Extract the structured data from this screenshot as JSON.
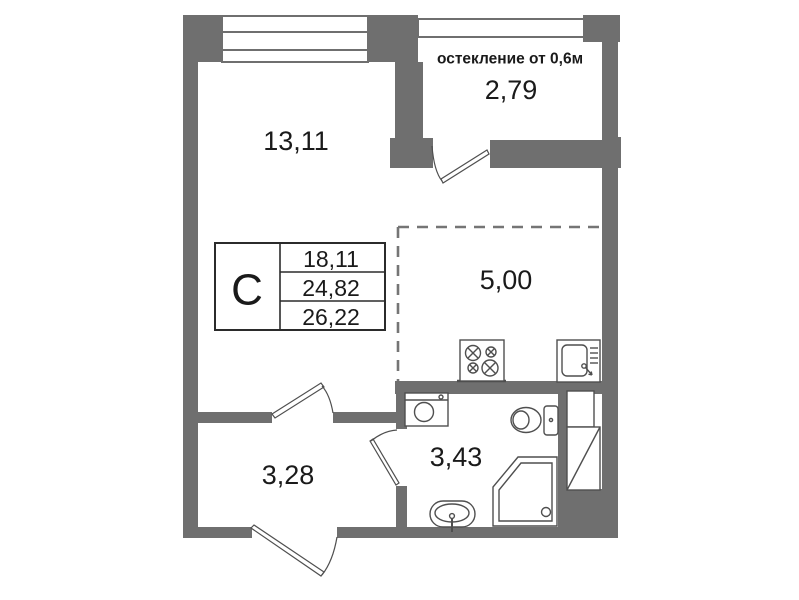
{
  "floor_plan": {
    "rooms": {
      "living_room": {
        "area": "13,11"
      },
      "balcony": {
        "area": "2,79",
        "glazing_note": "остекление от 0,6м"
      },
      "kitchen_zone": {
        "area": "5,00"
      },
      "hallway": {
        "area": "3,28"
      },
      "bathroom": {
        "area": "3,43"
      }
    },
    "info_table": {
      "type_label": "С",
      "values": [
        "18,11",
        "24,82",
        "26,22"
      ]
    },
    "colors": {
      "wall": "#6f6f6f",
      "line": "#4f4f4f",
      "dashed_line": "#757575",
      "text": "#1a1a1a",
      "background": "#ffffff"
    }
  }
}
